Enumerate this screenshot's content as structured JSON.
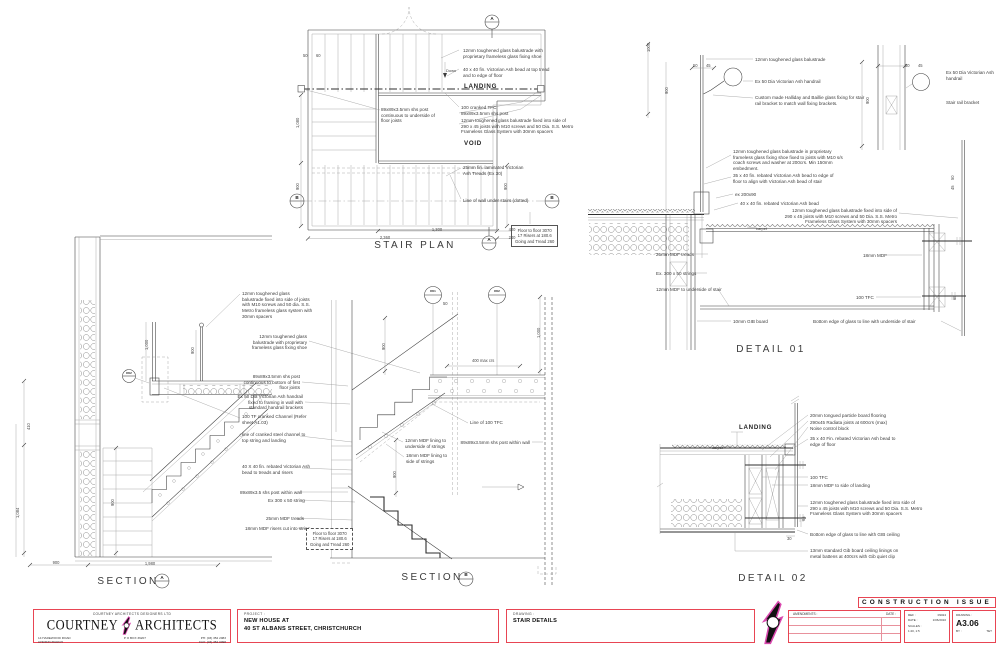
{
  "colors": {
    "accent_red": "#e84553",
    "logo_magenta": "#d948ae",
    "line_gray": "#3a3a3a"
  },
  "title_block": {
    "firm_top": "COURTNEY ARCHITECTS   DESIGNERS LTD",
    "firm_name_left": "COURTNEY",
    "firm_name_right": "ARCHITECTS",
    "address_line1": "14 HAREWOOD ROAD",
    "address_line2": "CHRISTCHURCH",
    "po_box": "P O BOX 36207",
    "phone": "PH: (03) 352 2083",
    "fax": "FAX: (03) 352 0098",
    "project_label": "PROJECT :",
    "project_line1": "NEW HOUSE  AT",
    "project_line2": "40 ST ALBANS STREET, CHRISTCHURCH",
    "drawing_label": "DRAWING :",
    "drawing_title": "STAIR DETAILS",
    "banner": "CONSTRUCTION ISSUE",
    "amendments_label": "AMENDMENTS :",
    "amend_date_label": "DATE :",
    "ref_label": "REF :",
    "ref_value": "09024",
    "date_label": "DATE :",
    "date_value": "1/06/2010",
    "scales_label": "SCALES :",
    "scales_value": "1:20, 1:5",
    "drawing_no_label": "DRAWING :",
    "drawing_no": "A3.06",
    "by_label": "BY :",
    "by_value": "TET"
  },
  "drawing": {
    "labels": [
      {
        "x": 463,
        "y": 48,
        "t": "12mm toughened glass balustrade with\nproprietary frameless glass fixing shoe"
      },
      {
        "x": 463,
        "y": 67,
        "t": "40 x 40 fin. Victorian Ash bead at top tread\nand to edge of floor"
      },
      {
        "x": 446,
        "y": 67.5,
        "t": "Down",
        "c": "sm"
      },
      {
        "x": 464,
        "y": 83,
        "t": "LANDING",
        "c": "hdr",
        "n": "landing-label"
      },
      {
        "x": 461,
        "y": 105,
        "t": "100 cranked TFC"
      },
      {
        "x": 461,
        "y": 111,
        "t": "89x89x3.5mm shs post"
      },
      {
        "x": 461,
        "y": 118,
        "t": "12mm toughened glass balustrade fixed into side of\n290 x 45 joists with M10 screws and 50 Dia. S.S. Metro\nFrameless Glass System with 30mm spacers"
      },
      {
        "x": 381,
        "y": 107,
        "t": "89x89x3.5mm shs post\ncontinuous to underside of\nfloor joists"
      },
      {
        "x": 464,
        "y": 140,
        "t": "VOID",
        "c": "hdr",
        "n": "void-label"
      },
      {
        "x": 463,
        "y": 165,
        "t": "25mm fin. laminated Victorian\nAsh Treads (Ex 30)"
      },
      {
        "x": 463,
        "y": 198,
        "t": "Line of wall under stairs (dotted)"
      },
      {
        "x": 511,
        "y": 225,
        "t": "Floor to floor 3070\n17 Risers at 180.6\nGoing and Tread 260",
        "c": "box"
      },
      {
        "x": 437,
        "y": 226.5,
        "t": "1,300",
        "c": "dim",
        "a": "c"
      },
      {
        "x": 512,
        "y": 226.5,
        "t": "400",
        "c": "dim",
        "a": "c"
      },
      {
        "x": 385,
        "y": 234.5,
        "t": "2,360",
        "c": "dim",
        "a": "c"
      },
      {
        "x": 512,
        "y": 234.5,
        "t": "240",
        "c": "dim",
        "a": "c"
      },
      {
        "x": 295,
        "y": 128,
        "t": "1,080",
        "c": "dimr"
      },
      {
        "x": 295,
        "y": 190,
        "t": "900",
        "c": "dimr"
      },
      {
        "x": 503,
        "y": 190,
        "t": "900",
        "c": "dimr"
      },
      {
        "x": 303,
        "y": 53,
        "t": "50",
        "c": "dim"
      },
      {
        "x": 316,
        "y": 53,
        "t": "60",
        "c": "dim"
      },
      {
        "x": 415,
        "y": 240,
        "t": "STAIR PLAN",
        "c": "title",
        "a": "c",
        "n": "view-title-stair-plan"
      },
      {
        "x": 492,
        "y": 16,
        "t": "A",
        "c": "mk",
        "a": "c"
      },
      {
        "x": 489,
        "y": 237,
        "t": "A",
        "c": "mk",
        "a": "c"
      },
      {
        "x": 297,
        "y": 195,
        "t": "B",
        "c": "mk",
        "a": "c"
      },
      {
        "x": 552,
        "y": 195,
        "t": "B",
        "c": "mk",
        "a": "c"
      },
      {
        "x": 755,
        "y": 57,
        "t": "12mm toughened glass balustrade"
      },
      {
        "x": 755,
        "y": 79,
        "t": "Ex 50 Dia Victorian Ash handrail"
      },
      {
        "x": 755,
        "y": 95,
        "t": "Custom made Halliday and Baillie glass fixing for stair\nrail bracket to match wall fixing brackets."
      },
      {
        "x": 946,
        "y": 70,
        "t": "Ex 50 Dia Victorian Ash\nhandrail"
      },
      {
        "x": 946,
        "y": 100,
        "t": "Stair rail bracket"
      },
      {
        "x": 733,
        "y": 149,
        "t": "12mm toughened glass balustrade in proprietary\nframeless glass fixing shoe fixed to joists with M10 s/s\ncoach screws and washer at 200crs. Min 150mm\nembedment."
      },
      {
        "x": 733,
        "y": 173,
        "t": "35 x 40 fin. rebated Victorian Ash bead to edge of\nfloor to align with Victorian Ash bead of stair"
      },
      {
        "x": 735,
        "y": 192,
        "t": "ex 200x90"
      },
      {
        "x": 740,
        "y": 201,
        "t": "40 x 40 fin. rebated Victorian Ash bead"
      },
      {
        "x": 897,
        "y": 208,
        "t": "12mm toughened glass balustrade fixed into side of\n290 x 45 joists with M10 screws and 50 Dia. S.S. Metro\nFrameless Glass System with 30mm spacers",
        "a": "r"
      },
      {
        "x": 756,
        "y": 226,
        "t": "carpet",
        "c": "sm"
      },
      {
        "x": 656,
        "y": 252,
        "t": "25mm MDF treads"
      },
      {
        "x": 863,
        "y": 253,
        "t": "18mm MDF"
      },
      {
        "x": 656,
        "y": 271,
        "t": "Ex. 300 x 50 strings"
      },
      {
        "x": 656,
        "y": 287,
        "t": "12mm MDF to underside of stair"
      },
      {
        "x": 856,
        "y": 295,
        "t": "100 TFC"
      },
      {
        "x": 733,
        "y": 319,
        "t": "10mm GIB board"
      },
      {
        "x": 813,
        "y": 319,
        "t": "Bottom edge of glass to line with underside of stair"
      },
      {
        "x": 771,
        "y": 344,
        "t": "DETAIL 01",
        "c": "title",
        "a": "c",
        "n": "view-title-detail-01"
      },
      {
        "x": 646,
        "y": 52,
        "t": "1000",
        "c": "dimr"
      },
      {
        "x": 664,
        "y": 94,
        "t": "900",
        "c": "dimr"
      },
      {
        "x": 693,
        "y": 63,
        "t": "50",
        "c": "dim"
      },
      {
        "x": 706,
        "y": 63,
        "t": "45",
        "c": "dim"
      },
      {
        "x": 865,
        "y": 104,
        "t": "900",
        "c": "dimr"
      },
      {
        "x": 905,
        "y": 63,
        "t": "50",
        "c": "dim"
      },
      {
        "x": 918,
        "y": 63,
        "t": "45",
        "c": "dim"
      },
      {
        "x": 950,
        "y": 180,
        "t": "50",
        "c": "dimr"
      },
      {
        "x": 950,
        "y": 190,
        "t": "45",
        "c": "dimr"
      },
      {
        "x": 952,
        "y": 300,
        "t": "65",
        "c": "dimr"
      },
      {
        "x": 242,
        "y": 291,
        "t": "12mm toughened glass\nbalustrade fixed into side of joists\nwith M10 screws and 50 dia. S.S.\nMetro frameless glass system with\n30mm spacers"
      },
      {
        "x": 307,
        "y": 334,
        "t": "12mm toughened glass\nbalustrade with proprietary\nframeless glass fixing shoe",
        "a": "r"
      },
      {
        "x": 300,
        "y": 374,
        "t": "89x89x3.5mm shs post\ncontinuous to bottom of first\nfloor joists",
        "a": "r"
      },
      {
        "x": 303,
        "y": 394,
        "t": "Ex 50 Dia Victorian Ash handrail\nfixed to framing in wall with\nstandard handrail brackets",
        "a": "r"
      },
      {
        "x": 242,
        "y": 414,
        "t": "100 TF cranked Channel (Refer\nsheet A1.03)"
      },
      {
        "x": 242,
        "y": 432,
        "t": "line of cranked steel channel to\ntop string and landing"
      },
      {
        "x": 242,
        "y": 464,
        "t": "40 X 40 fin. rebated Victorian Ash\nbead to treads and risers"
      },
      {
        "x": 240,
        "y": 490,
        "t": "89x89x3.5 shs post within wall"
      },
      {
        "x": 268,
        "y": 498,
        "t": "Ex 300 x 50 string"
      },
      {
        "x": 266,
        "y": 516,
        "t": "25mm MDF treads"
      },
      {
        "x": 245,
        "y": 526,
        "t": "18mm MDF risers cut into string"
      },
      {
        "x": 306,
        "y": 528,
        "t": "Floor to floor 3070\n17 Risers at 180.6\nGoing and Tread 260",
        "c": "boxd"
      },
      {
        "x": 26,
        "y": 430,
        "t": "410",
        "c": "dimr"
      },
      {
        "x": 15,
        "y": 518,
        "t": "1,084",
        "c": "dimr"
      },
      {
        "x": 110,
        "y": 506,
        "t": "900",
        "c": "dimr"
      },
      {
        "x": 56,
        "y": 560,
        "t": "900",
        "c": "dim",
        "a": "c"
      },
      {
        "x": 150,
        "y": 561,
        "t": "1,980",
        "c": "dim",
        "a": "c"
      },
      {
        "x": 144,
        "y": 350,
        "t": "1,000",
        "c": "dimr"
      },
      {
        "x": 190,
        "y": 354,
        "t": "900",
        "c": "dimr"
      },
      {
        "x": 128,
        "y": 576,
        "t": "SECTION",
        "c": "title",
        "a": "c",
        "n": "view-title-section-a"
      },
      {
        "x": 162,
        "y": 575,
        "t": "A",
        "c": "mk",
        "a": "c"
      },
      {
        "x": 129,
        "y": 371.5,
        "t": "D02",
        "c": "mkd",
        "a": "c"
      },
      {
        "x": 433,
        "y": 290,
        "t": "D01",
        "c": "mkd",
        "a": "c"
      },
      {
        "x": 497,
        "y": 290,
        "t": "D02",
        "c": "mkd",
        "a": "c"
      },
      {
        "x": 443,
        "y": 301,
        "t": "50",
        "c": "dim"
      },
      {
        "x": 472,
        "y": 358,
        "t": "400 max crs",
        "c": "dim"
      },
      {
        "x": 536,
        "y": 338,
        "t": "1,000",
        "c": "dimr"
      },
      {
        "x": 381,
        "y": 350,
        "t": "900",
        "c": "dimr"
      },
      {
        "x": 392,
        "y": 478,
        "t": "900",
        "c": "dimr"
      },
      {
        "x": 470,
        "y": 420,
        "t": "Line of 100 TFC"
      },
      {
        "x": 530,
        "y": 440,
        "t": "89x89x3.5mm shs post within wall",
        "a": "r"
      },
      {
        "x": 405,
        "y": 438,
        "t": "12mm MDF lining to\nunderside of strings"
      },
      {
        "x": 406,
        "y": 453,
        "t": "18mm MDF lining to\nside of strings"
      },
      {
        "x": 432,
        "y": 572,
        "t": "SECTION",
        "c": "title",
        "a": "c",
        "n": "view-title-section-b"
      },
      {
        "x": 466,
        "y": 572,
        "t": "B",
        "c": "mk",
        "a": "c"
      },
      {
        "x": 739,
        "y": 424,
        "t": "LANDING",
        "c": "hdr",
        "n": "landing-label-detail-02"
      },
      {
        "x": 712,
        "y": 444.5,
        "t": "carpet",
        "c": "sm"
      },
      {
        "x": 810,
        "y": 413,
        "t": "20mm tongued particle board flooring"
      },
      {
        "x": 810,
        "y": 419.5,
        "t": "290x45 Radiata joists at 600crs (max)"
      },
      {
        "x": 810,
        "y": 426,
        "t": "Noise control block"
      },
      {
        "x": 810,
        "y": 436,
        "t": "35 x 40 Fin. rebated Victorian Ash bead to\nedge of floor"
      },
      {
        "x": 810,
        "y": 475,
        "t": "100 TFC"
      },
      {
        "x": 810,
        "y": 483,
        "t": "18mm MDF to side of landing"
      },
      {
        "x": 810,
        "y": 500,
        "t": "12mm toughened glass balustrade fixed into side of\n290 x 45 joists with M10 screws and 50 Dia. S.S. Metro\nFrameless Glass System with 30mm spacers"
      },
      {
        "x": 810,
        "y": 532,
        "t": "Bottom edge of glass to line with GIB ceiling"
      },
      {
        "x": 810,
        "y": 548,
        "t": "13mm standard Gib board ceiling linings on\nmetal battens at 400crs with Gib quiet clip"
      },
      {
        "x": 773,
        "y": 573,
        "t": "DETAIL 02",
        "c": "title",
        "a": "c",
        "n": "view-title-detail-02"
      },
      {
        "x": 801,
        "y": 521,
        "t": "65",
        "c": "dimr"
      },
      {
        "x": 787,
        "y": 536,
        "t": "30",
        "c": "dim"
      }
    ]
  }
}
